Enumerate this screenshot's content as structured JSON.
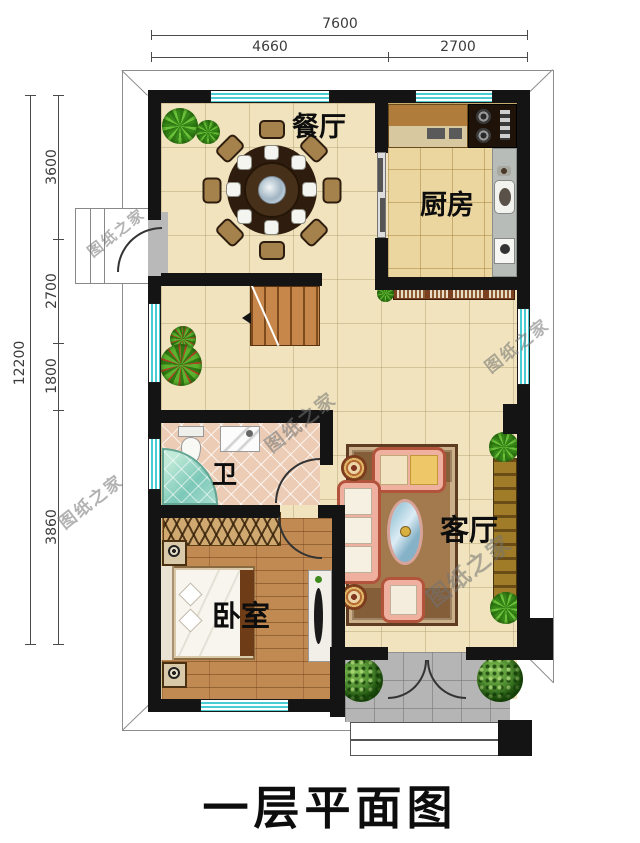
{
  "plan_title": "一层平面图",
  "watermark": {
    "text": "图纸之家"
  },
  "rooms": {
    "dining": {
      "label": "餐厅"
    },
    "kitchen": {
      "label": "厨房"
    },
    "bathroom": {
      "label": "卫"
    },
    "living": {
      "label": "客厅"
    },
    "bedroom": {
      "label": "卧室"
    }
  },
  "dimensions": {
    "top": {
      "overall": "7600",
      "segments": [
        "4660",
        "2700"
      ]
    },
    "left": {
      "overall": "12200",
      "segments": [
        "3600",
        "2700",
        "1800",
        "3860"
      ]
    }
  },
  "colors": {
    "wall": "#141414",
    "window_teal": "#49cdd2",
    "floor_beige": "#f0e3bd",
    "kitchen_tile": "#ead69e",
    "bedroom_wood": "#c08a52",
    "porch_gray": "#b5b5b5"
  }
}
